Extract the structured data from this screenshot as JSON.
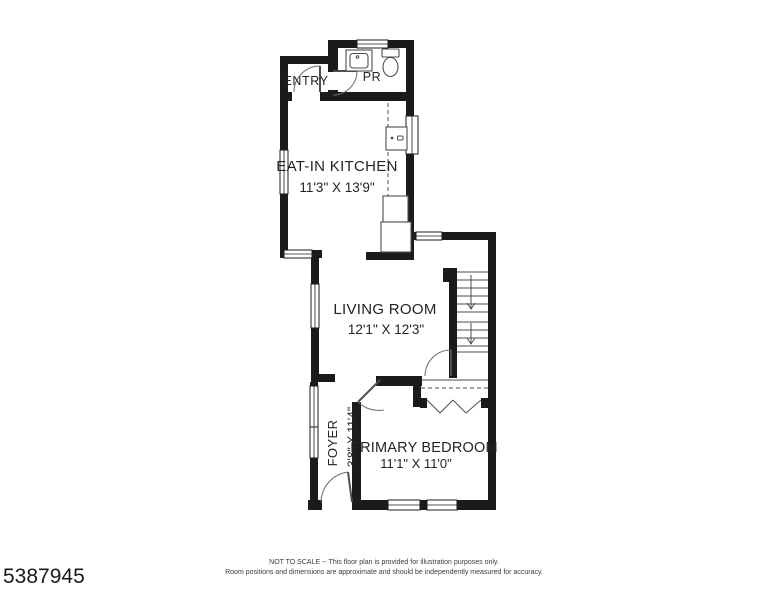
{
  "colors": {
    "background": "#ffffff",
    "wall": "#1b1b1b",
    "thin_line": "#4d4d4d",
    "text": "#232323"
  },
  "rooms": {
    "entry": {
      "name": "ENTRY"
    },
    "powder_room": {
      "name": "PR"
    },
    "kitchen": {
      "name": "EAT-IN KITCHEN",
      "dims": "11'3\" X 13'9\""
    },
    "living_room": {
      "name": "LIVING ROOM",
      "dims": "12'1\" X 12'3\""
    },
    "foyer": {
      "name": "FOYER",
      "dims": "3'8\" X 11'4\""
    },
    "primary_bedroom": {
      "name": "PRIMARY BEDROOM",
      "dims": "11'1\" X 11'0\""
    }
  },
  "footer": {
    "listing_id": "5387945",
    "disclaimer_line1": "NOT TO SCALE -- This floor plan is provided for illustration purposes only.",
    "disclaimer_line2": "Room positions and dimensions are approximate and should be independently measured for accuracy."
  }
}
